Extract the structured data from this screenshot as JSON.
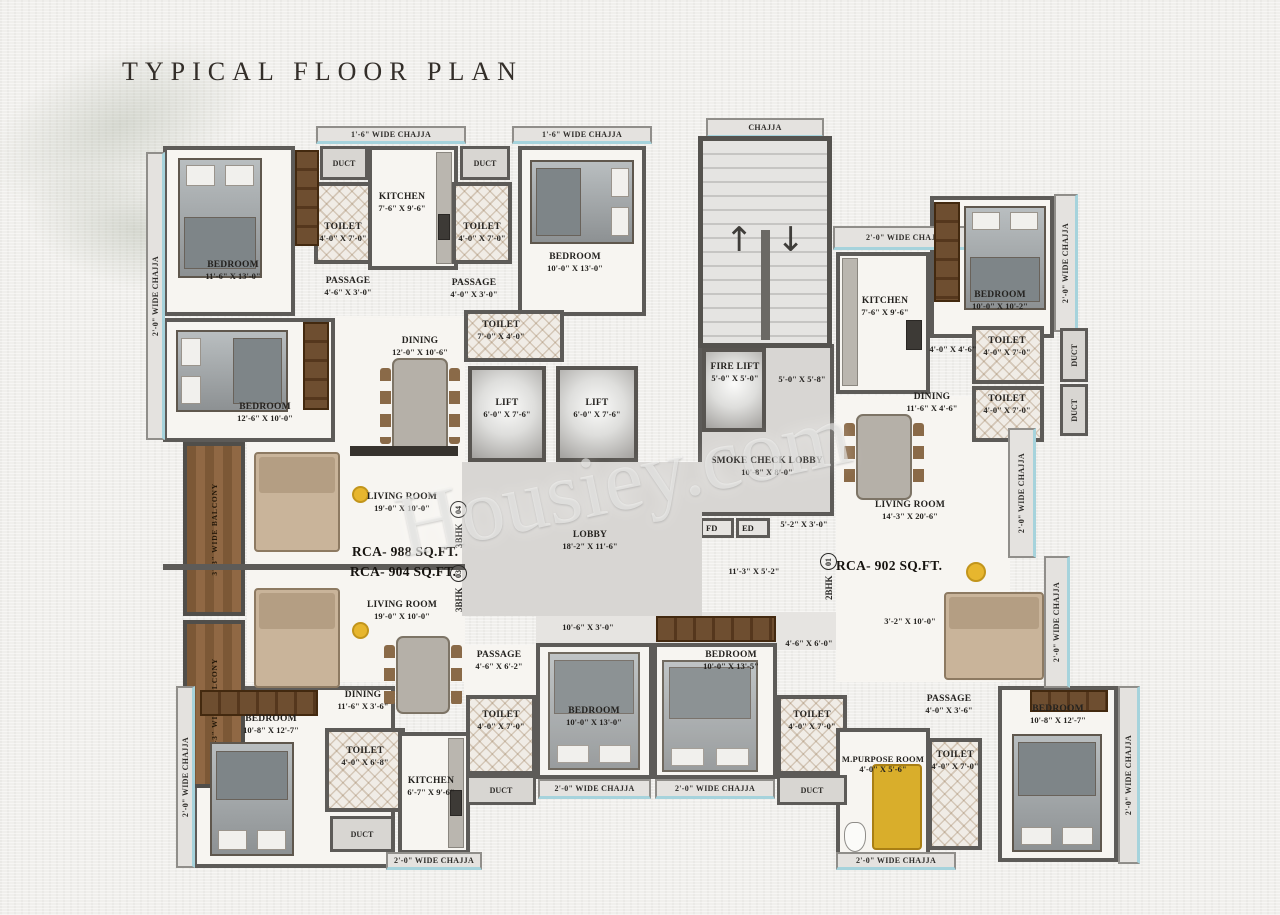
{
  "title": "TYPICAL FLOOR PLAN",
  "watermark": "Housiey.com",
  "shared": {
    "duct": "DUCT",
    "chajja": "CHAJJA",
    "chajja_16": "1'-6\" WIDE CHAJJA",
    "chajja_20": "2'-0\" WIDE CHAJJA",
    "balcony_33": "3'-3\" WIDE BALCONY"
  },
  "core": {
    "lift_name": "LIFT",
    "lift_dims": "6'-0\" X 7'-6\"",
    "fire_lift_name": "FIRE LIFT",
    "fire_lift_dims": "5'-0\" X 5'-0\"",
    "fire_lobby_dims": "5'-0\" X 5'-8\"",
    "smoke_name": "SMOKE CHECK LOBBY",
    "smoke_dims": "10'-8\" X 8'-0\"",
    "fd": "FD",
    "ed": "ED",
    "fd_dims": "5'-2\" X 3'-0\"",
    "lobby_name": "LOBBY",
    "lobby_dims": "18'-2\" X 11'-6\"",
    "lobby_dims2": "11'-3\" X 5'-2\"",
    "corridor_dims": "10'-6\" X 3'-0\""
  },
  "flats": {
    "f04": {
      "type": "3BHK",
      "num": "04",
      "area": "RCA- 988 SQ.FT."
    },
    "f03": {
      "type": "3BHK",
      "num": "03",
      "area": "RCA- 904 SQ.FT."
    },
    "f01": {
      "type": "2BHK",
      "num": "01",
      "area": "RCA- 902 SQ.FT."
    }
  },
  "rooms": {
    "tl_bedroom": {
      "name": "BEDROOM",
      "dims": "11'-6\" X 13'-0\""
    },
    "tl_toilet_a": {
      "name": "TOILET",
      "dims": "4'-0\" X 7'-0\""
    },
    "tl_kitchen": {
      "name": "KITCHEN",
      "dims": "7'-6\" X 9'-6\""
    },
    "tl_toilet_b": {
      "name": "TOILET",
      "dims": "4'-0\" X 7'-0\""
    },
    "tl_passage_a": {
      "name": "PASSAGE",
      "dims": "4'-6\" X 3'-0\""
    },
    "tl_passage_b": {
      "name": "PASSAGE",
      "dims": "4'-0\" X 3'-0\""
    },
    "tm_bedroom": {
      "name": "BEDROOM",
      "dims": "10'-0\" X 13'-0\""
    },
    "ml_bedroom": {
      "name": "BEDROOM",
      "dims": "12'-6\" X 10'-0\""
    },
    "ml_dining": {
      "name": "DINING",
      "dims": "12'-0\" X 10'-6\""
    },
    "c_toilet": {
      "name": "TOILET",
      "dims": "7'-0\" X 4'-0\""
    },
    "f04_living": {
      "name": "LIVING ROOM",
      "dims": "19'-0\" X 10'-0\""
    },
    "f03_living": {
      "name": "LIVING ROOM",
      "dims": "19'-0\" X 10'-0\""
    },
    "f03_dining": {
      "name": "DINING",
      "dims": "11'-6\" X 3'-6\""
    },
    "bl_bedroom": {
      "name": "BEDROOM",
      "dims": "10'-8\" X 12'-7\""
    },
    "bl_toilet": {
      "name": "TOILET",
      "dims": "4'-0\" X 6'-8\""
    },
    "bl_kitchen": {
      "name": "KITCHEN",
      "dims": "6'-7\" X 9'-6\""
    },
    "bc_passage": {
      "name": "PASSAGE",
      "dims": "4'-6\" X 6'-2\""
    },
    "bc_toilet_l": {
      "name": "TOILET",
      "dims": "4'-0\" X 7'-0\""
    },
    "bc_bedroom_l": {
      "name": "BEDROOM",
      "dims": "10'-0\" X 13'-0\""
    },
    "bc_bedroom_r": {
      "name": "BEDROOM",
      "dims": "10'-0\" X 13'-5\""
    },
    "bc_dims2": "4'-6\" X 6'-0\"",
    "bc_toilet_r": {
      "name": "TOILET",
      "dims": "4'-0\" X 7'-0\""
    },
    "br_passage": {
      "name": "PASSAGE",
      "dims": "4'-0\" X 3'-6\""
    },
    "br_mpurpose": {
      "name": "M.PURPOSE ROOM",
      "dims": "4'-0\" X 5'-6\""
    },
    "br_toilet": {
      "name": "TOILET",
      "dims": "4'-0\" X 7'-0\""
    },
    "br_bedroom": {
      "name": "BEDROOM",
      "dims": "10'-8\" X 12'-7\""
    },
    "br_dims": "3'-2\" X 10'-0\"",
    "r_kitchen": {
      "name": "KITCHEN",
      "dims": "7'-6\" X 9'-6\""
    },
    "r_bedroom": {
      "name": "BEDROOM",
      "dims": "10'-0\" X 10'-2\""
    },
    "r_pass_dims": "4'-0\" X 4'-6\"",
    "r_toilet_a": {
      "name": "TOILET",
      "dims": "4'-0\" X 7'-0\""
    },
    "r_toilet_b": {
      "name": "TOILET",
      "dims": "4'-0\" X 7'-0\""
    },
    "r_dining": {
      "name": "DINING",
      "dims": "11'-6\" X 4'-6\""
    },
    "r_living": {
      "name": "LIVING ROOM",
      "dims": "14'-3\" X 20'-6\""
    }
  },
  "colors": {
    "wall": "#5d5b58",
    "accent_cyan": "#a6d3dc",
    "accent_yellow": "#e7b62e",
    "balcony_wood": "#7c5836"
  }
}
